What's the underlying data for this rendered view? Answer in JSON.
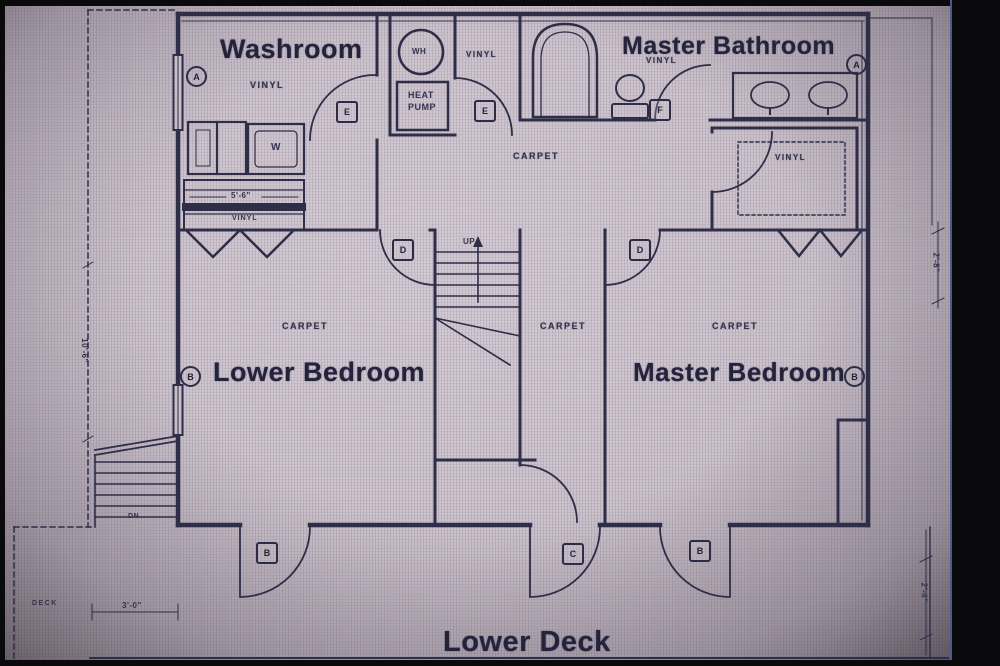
{
  "rooms": {
    "washroom": {
      "title": "Washroom",
      "floor": "VINYL",
      "cabinet_label": "VINYL"
    },
    "master_bathroom": {
      "title": "Master Bathroom",
      "floor": "VINYL"
    },
    "walkin_closet": {
      "floor": "VINYL"
    },
    "utility": {
      "floor": "VINYL"
    },
    "hall": {
      "floor": "CARPET"
    },
    "corridor": {
      "floor": "CARPET"
    },
    "lower_bedroom": {
      "title": "Lower Bedroom",
      "floor": "CARPET"
    },
    "master_bedroom": {
      "title": "Master Bedroom",
      "floor": "CARPET"
    },
    "lower_deck": {
      "title": "Lower Deck"
    },
    "side_deck": {
      "label": "DECK"
    }
  },
  "fixtures": {
    "water_heater": "WH",
    "heat_pump_line1": "HEAT",
    "heat_pump_line2": "PUMP",
    "washer": "W",
    "stairs_up": "UP",
    "stairs_down": "DN"
  },
  "door_tags": {
    "washroom_door": "E",
    "utility_door": "E",
    "master_bath_door": "F",
    "lower_bedroom_door": "D",
    "master_bedroom_door": "D",
    "deck_door_left": "B",
    "deck_door_center": "C",
    "deck_door_right": "B"
  },
  "window_tags": {
    "washroom": "A",
    "master_bathroom": "A",
    "lower_bedroom": "B",
    "master_bedroom": "B"
  },
  "dimensions": {
    "cabinet_width": "5'-6\"",
    "right_upper": "2'-8\"",
    "right_lower": "2'-4\"",
    "deck_stair_width": "3'-0\"",
    "left_height": "10'-6\""
  },
  "colors": {
    "paper": "#c7bdc7",
    "ink": "#2e2e48",
    "bold_text": "#1f1f38"
  }
}
